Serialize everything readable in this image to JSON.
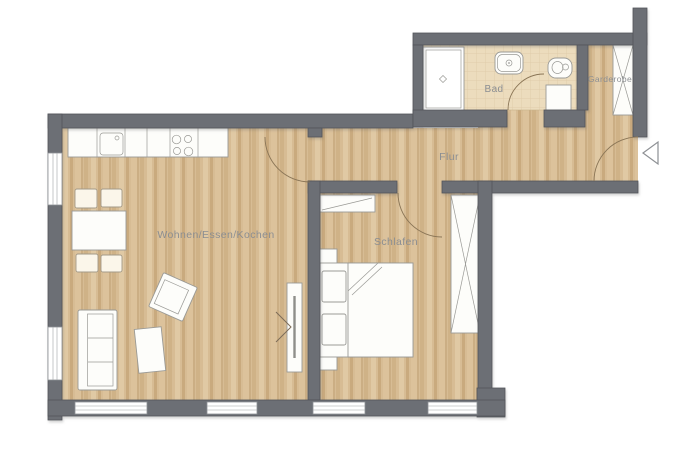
{
  "rooms": {
    "living": {
      "label": "Wohnen/Essen/Kochen"
    },
    "bedroom": {
      "label": "Schlafen"
    },
    "hallway": {
      "label": "Flur"
    },
    "bathroom": {
      "label": "Bad"
    },
    "wardrobe": {
      "label": "Garderobe"
    }
  },
  "colors": {
    "background": "#ffffff",
    "wall": "#6c6f75",
    "wood": "#d7bc94",
    "tile": "#ecdcbd",
    "label": "#8b8e92",
    "furniture": "#fdfdfa",
    "outline": "#9a9a96",
    "arc": "#8a7556"
  }
}
